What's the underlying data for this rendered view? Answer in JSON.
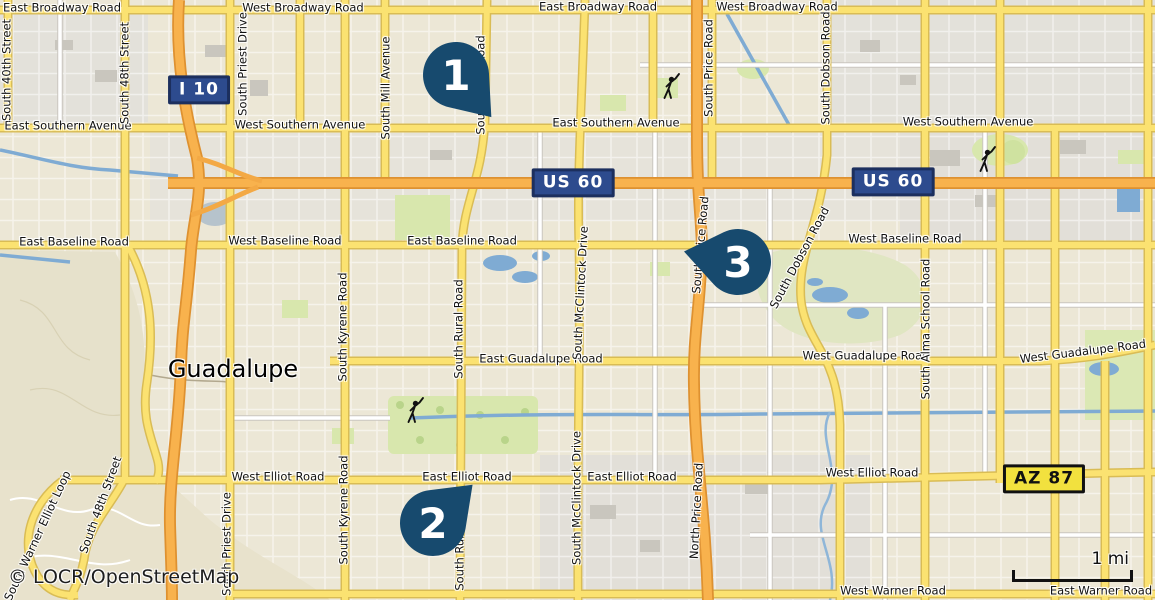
{
  "map": {
    "attribution": "© LOCR/OpenStreetMap",
    "scale_label": "1 mi",
    "city_label": "Guadalupe",
    "colors": {
      "marker": "#174a6e",
      "interstate_shield_fill": "#2d4b8e",
      "shield_border": "#1c2f5e",
      "state_shield_fill": "#f2e13e",
      "major_road_yellow": "#fbe271",
      "freeway_orange": "#f8b24d",
      "water_blue": "#7fabd3"
    },
    "markers": [
      {
        "number": "1",
        "x": 456,
        "y": 75,
        "angle": 50
      },
      {
        "number": "2",
        "x": 433,
        "y": 523,
        "angle": -44
      },
      {
        "number": "3",
        "x": 738,
        "y": 262,
        "angle": 191
      }
    ],
    "shields": [
      {
        "system": "interstate",
        "label": "I 10",
        "x": 199,
        "y": 90
      },
      {
        "system": "us-route",
        "label": "US 60",
        "x": 573,
        "y": 183
      },
      {
        "system": "us-route",
        "label": "US 60",
        "x": 893,
        "y": 182
      },
      {
        "system": "state-route",
        "label": "AZ 87",
        "x": 1044,
        "y": 479
      }
    ],
    "poi_icons": [
      {
        "name": "golfer-icon",
        "x": 668,
        "y": 90
      },
      {
        "name": "golfer-icon",
        "x": 984,
        "y": 163
      },
      {
        "name": "golfer-icon",
        "x": 412,
        "y": 414
      }
    ],
    "road_labels": [
      {
        "text": "East Broadway Road",
        "x": 62,
        "y": 8,
        "rot": 0
      },
      {
        "text": "West Broadway Road",
        "x": 303,
        "y": 8,
        "rot": 0
      },
      {
        "text": "East Broadway Road",
        "x": 598,
        "y": 7,
        "rot": 0
      },
      {
        "text": "West Broadway Road",
        "x": 777,
        "y": 7,
        "rot": 0
      },
      {
        "text": "East Southern Avenue",
        "x": 68,
        "y": 126,
        "rot": 0
      },
      {
        "text": "West Southern Avenue",
        "x": 300,
        "y": 125,
        "rot": 0
      },
      {
        "text": "East Southern Avenue",
        "x": 616,
        "y": 123,
        "rot": 0
      },
      {
        "text": "West Southern Avenue",
        "x": 968,
        "y": 122,
        "rot": 0
      },
      {
        "text": "East Baseline Road",
        "x": 74,
        "y": 242,
        "rot": 0
      },
      {
        "text": "West Baseline Road",
        "x": 285,
        "y": 241,
        "rot": 0
      },
      {
        "text": "East Baseline Road",
        "x": 462,
        "y": 241,
        "rot": 0
      },
      {
        "text": "West Baseline Road",
        "x": 905,
        "y": 239,
        "rot": 0
      },
      {
        "text": "East Guadalupe Road",
        "x": 541,
        "y": 359,
        "rot": 0
      },
      {
        "text": "West Guadalupe Road",
        "x": 866,
        "y": 356,
        "rot": 0
      },
      {
        "text": "West Guadalupe Road",
        "x": 1083,
        "y": 352,
        "rot": -7
      },
      {
        "text": "West Elliot Road",
        "x": 278,
        "y": 477,
        "rot": 0
      },
      {
        "text": "East Elliot Road",
        "x": 467,
        "y": 477,
        "rot": 0
      },
      {
        "text": "East Elliot Road",
        "x": 632,
        "y": 477,
        "rot": 0
      },
      {
        "text": "West Elliot Road",
        "x": 872,
        "y": 473,
        "rot": 0
      },
      {
        "text": "West Warner Road",
        "x": 893,
        "y": 591,
        "rot": 0
      },
      {
        "text": "East Warner Road",
        "x": 1101,
        "y": 591,
        "rot": 0
      },
      {
        "text": "South 40th Street",
        "x": 7,
        "y": 70,
        "rot": -90
      },
      {
        "text": "South 48th Street",
        "x": 125,
        "y": 73,
        "rot": -90
      },
      {
        "text": "South Priest Drive",
        "x": 243,
        "y": 64,
        "rot": -90
      },
      {
        "text": "South Mill Avenue",
        "x": 386,
        "y": 88,
        "rot": -90
      },
      {
        "text": "South Rural Road",
        "x": 481,
        "y": 85,
        "rot": -90
      },
      {
        "text": "South Price Road",
        "x": 709,
        "y": 68,
        "rot": -90
      },
      {
        "text": "South Dobson Road",
        "x": 826,
        "y": 68,
        "rot": -90
      },
      {
        "text": "South Price Road",
        "x": 701,
        "y": 245,
        "rot": -85
      },
      {
        "text": "South Kyrene Road",
        "x": 343,
        "y": 327,
        "rot": -90
      },
      {
        "text": "South Rural Road",
        "x": 459,
        "y": 329,
        "rot": -90
      },
      {
        "text": "South McClintock Drive",
        "x": 581,
        "y": 293,
        "rot": -87
      },
      {
        "text": "South Dobson Road",
        "x": 800,
        "y": 258,
        "rot": -62
      },
      {
        "text": "South Alma School Road",
        "x": 926,
        "y": 329,
        "rot": -90
      },
      {
        "text": "South Priest Drive",
        "x": 227,
        "y": 544,
        "rot": -90
      },
      {
        "text": "South Kyrene Road",
        "x": 344,
        "y": 510,
        "rot": -90
      },
      {
        "text": "South McClintock Drive",
        "x": 577,
        "y": 498,
        "rot": -90
      },
      {
        "text": "South Rural Road",
        "x": 460,
        "y": 541,
        "rot": -90
      },
      {
        "text": "North Price Road",
        "x": 697,
        "y": 511,
        "rot": -87
      },
      {
        "text": "South 48th Street",
        "x": 101,
        "y": 505,
        "rot": -70
      },
      {
        "text": "South Warner Elliot Loop",
        "x": 38,
        "y": 536,
        "rot": -65
      }
    ]
  }
}
